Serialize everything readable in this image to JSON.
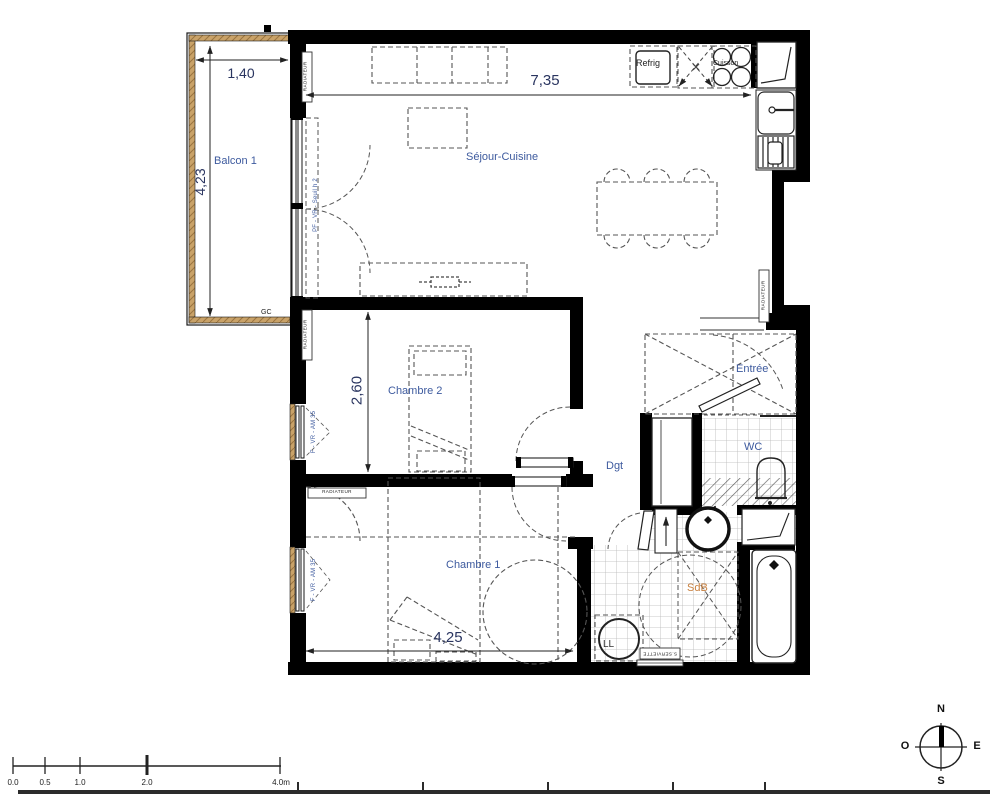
{
  "rooms": {
    "balcony": "Balcon 1",
    "living": "Séjour-Cuisine",
    "bedroom2": "Chambre 2",
    "bedroom1": "Chambre 1",
    "entry": "Entrée",
    "wc": "WC",
    "hallway": "Dgt",
    "bathroom": "SdB"
  },
  "dimensions": {
    "balcony_width": "1,40",
    "balcony_length": "4,23",
    "living_width": "7,35",
    "bedroom2_width": "2,60",
    "bedroom1_width": "4,25"
  },
  "annotations": {
    "gc": "GC",
    "fridge": "Refrig",
    "cooktop": "Cuisson",
    "washer": "LL",
    "towel_radiator": "S.SERVIETTE",
    "radiator": "RADIATEUR",
    "window_pf": "PF - VR - Seuil h 2",
    "window_f": "F - VR - AM 35"
  },
  "compass": {
    "north": "N",
    "south": "S",
    "east": "E",
    "west": "O"
  },
  "scale_bar": {
    "labels": [
      "0.0",
      "0.5",
      "1.0",
      "2.0",
      "4.0m"
    ]
  },
  "colors": {
    "wall": "#000000",
    "label_blue": "#3d5a9e",
    "label_orange": "#c8803f",
    "dimension_text": "#2a3560",
    "wood": "#c9a268"
  }
}
